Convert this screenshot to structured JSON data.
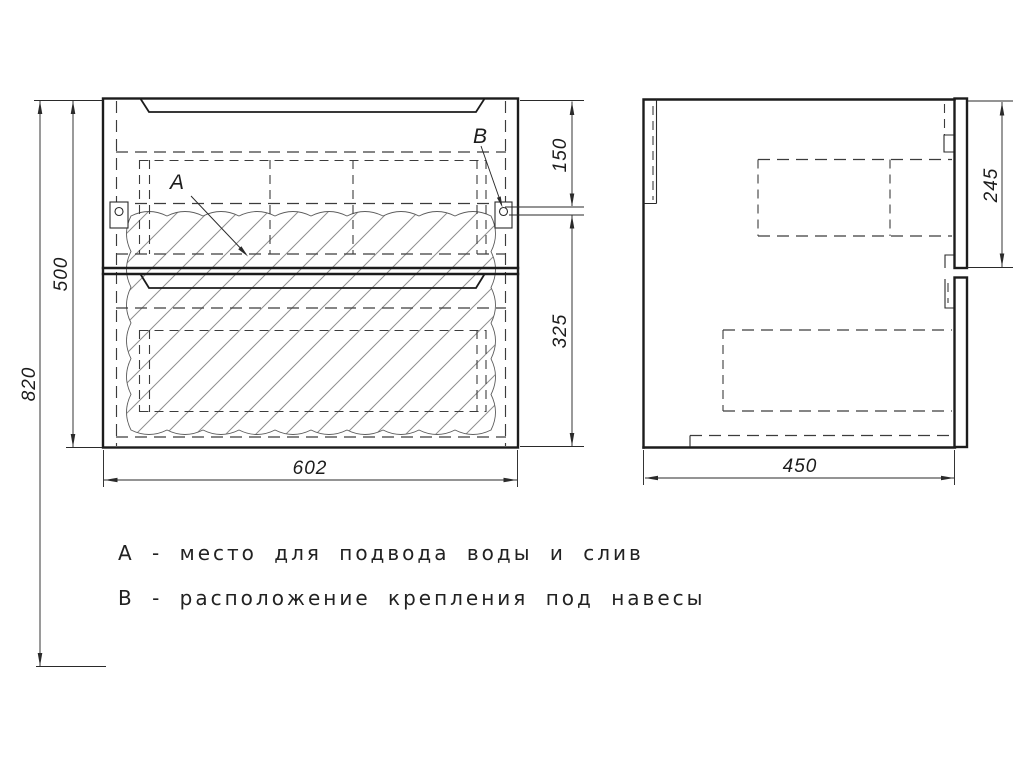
{
  "labels": {
    "a": "A",
    "b": "B"
  },
  "dimensions": {
    "overall_height": "820",
    "cabinet_height": "500",
    "cabinet_width": "602",
    "bracket_from_top": "150",
    "bracket_to_bottom": "325",
    "depth": "450",
    "drawer_front_height": "245"
  },
  "legend": {
    "item_a": "А - место для подвода воды и слив",
    "item_b": "В - расположение крепления под навесы"
  },
  "colors": {
    "line": "#1c1c1c",
    "background": "#ffffff"
  }
}
